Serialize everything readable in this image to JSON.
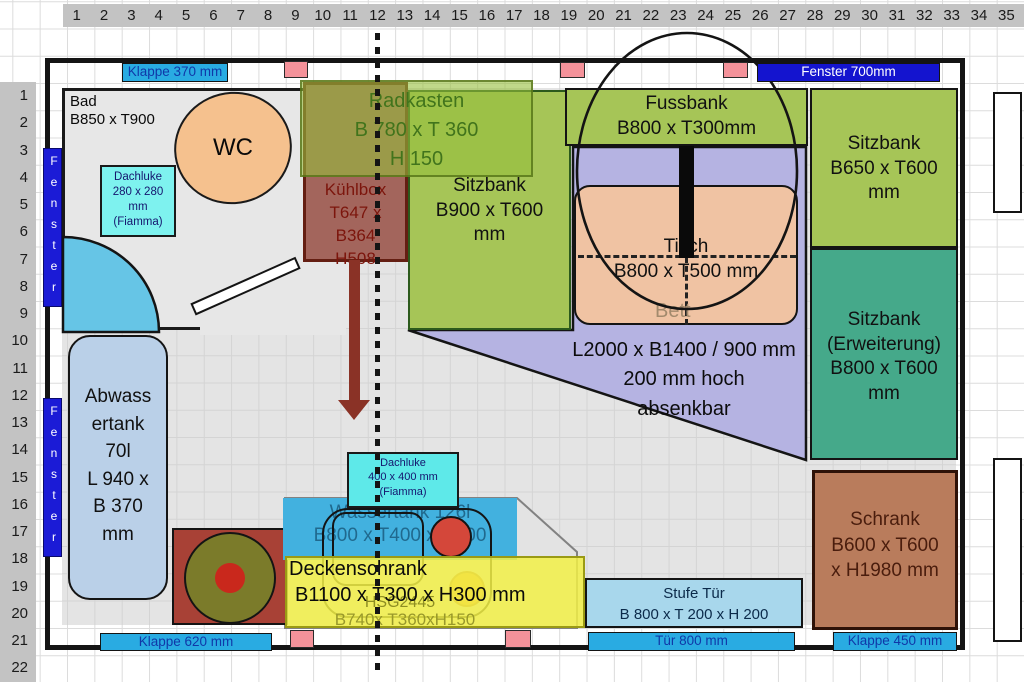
{
  "rulers": {
    "columns": [
      "1",
      "2",
      "3",
      "4",
      "5",
      "6",
      "7",
      "8",
      "9",
      "10",
      "11",
      "12",
      "13",
      "14",
      "15",
      "16",
      "17",
      "18",
      "19",
      "20",
      "21",
      "22",
      "23",
      "24",
      "25",
      "26",
      "27",
      "28",
      "29",
      "30",
      "31",
      "32",
      "33",
      "34",
      "35"
    ],
    "rows": [
      "1",
      "2",
      "3",
      "4",
      "5",
      "6",
      "7",
      "8",
      "9",
      "10",
      "11",
      "12",
      "13",
      "14",
      "15",
      "16",
      "17",
      "18",
      "19",
      "20",
      "21",
      "22"
    ]
  },
  "openings": {
    "klappe_top": "Klappe 370 mm",
    "fenster_top": "Fenster 700mm",
    "fenster_left": "Fenster",
    "klappe_bottom_left": "Klappe 620 mm",
    "tuer_bottom": "Tür 800 mm",
    "klappe_bottom_right": "Klappe 450 mm"
  },
  "bad": {
    "name": "Bad",
    "dim": "B850 x T900",
    "wc": "WC",
    "dachluke": [
      "Dachluke",
      "280 x 280",
      "mm",
      "(Fiamma)"
    ]
  },
  "kuehlbox": {
    "lines": [
      "Kühlbox",
      "T647 x",
      "B364",
      "H508"
    ]
  },
  "radkasten": {
    "lines": [
      "Radkasten",
      "B 780 x T 360",
      "H 150"
    ]
  },
  "sitzbank_mitte": {
    "lines": [
      "Sitzbank",
      "B900 x T600",
      "mm"
    ]
  },
  "fussbank": {
    "lines": [
      "Fussbank",
      "B800 x T300mm"
    ]
  },
  "sitzbank_rechts": {
    "lines": [
      "Sitzbank",
      "B650 x T600",
      "mm"
    ]
  },
  "sitzbank_erweiterung": {
    "lines": [
      "Sitzbank",
      "(Erweiterung)",
      "B800 x T600",
      "mm"
    ]
  },
  "tisch": {
    "lines": [
      "Tisch",
      "B800 x T500 mm"
    ]
  },
  "bett": {
    "label": "Bett",
    "lines": [
      "L2000 x B1400 / 900 mm",
      "200 mm hoch",
      "absenkbar"
    ]
  },
  "abwassertank": {
    "lines": [
      "Abwass",
      "ertank",
      "70l",
      "L 940 x",
      "B 370",
      "mm"
    ]
  },
  "dachluke400": {
    "lines": [
      "Dachluke",
      "400 x 400 mm",
      "(Fiamma)"
    ]
  },
  "wassertank": {
    "lines": [
      "Wassertank 126l",
      "B800 x T400 x H400"
    ]
  },
  "deckenschrank": {
    "line1": "Deckenschrank",
    "line2": "B1100 x T300 x H300 mm"
  },
  "hsg": {
    "line1": "HSG2445",
    "line2": "B740x T360xH150"
  },
  "schrank": {
    "lines": [
      "Schrank",
      "B600 x T600",
      "x H1980 mm"
    ]
  },
  "stufe": {
    "lines": [
      "Stufe Tür",
      "B 800 x T 200 x H 200"
    ]
  },
  "colors": {
    "bar_cyan": "#29abe2",
    "bar_blue": "#1414cf",
    "pink": "#f4929a",
    "bench_green": "#a6c557",
    "extension_teal": "#45a98a",
    "bed_purple": "#b5b3e2",
    "table_peach": "#f0c3a3",
    "kuehlbox_brown": "#a3655c",
    "schrank_brown": "#b97c5c",
    "deckenschrank_yellow": "#f2f046",
    "wassertank_blue": "#42b1df",
    "dachluke_cyan": "#5ee9e9",
    "abwassertank_blue": "#bad0e8"
  }
}
